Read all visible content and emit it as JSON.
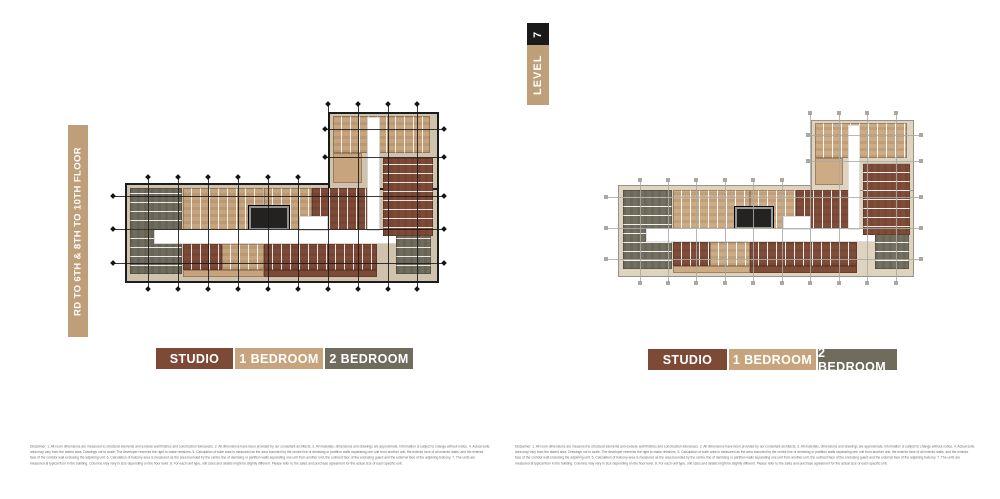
{
  "palette": {
    "studio": "#7d4a37",
    "one_bedroom": "#c7a47d",
    "two_bedroom": "#6f6b5d",
    "core": "#232220",
    "label_tan": "#bf9f7a",
    "label_black": "#1a1a1a"
  },
  "left_page": {
    "floor_label": "RD TO 6TH & 8TH TO 10TH FLOOR"
  },
  "right_page": {
    "level_badge": {
      "number": "7",
      "word": "LEVEL"
    }
  },
  "legend": {
    "items": [
      {
        "label": "STUDIO",
        "key": "studio"
      },
      {
        "label": "1 BEDROOM",
        "key": "one_bedroom"
      },
      {
        "label": "2 BEDROOM",
        "key": "two_bedroom"
      }
    ]
  },
  "disclaimer": "Disclaimer: 1. All room dimensions are measured to structural elements and exclude wall finishes and construction tolerances. 2. All dimensions have been provided by our consultant architects. 3. All materials, dimensions and drawings are approximate. Information is subject to change without notice. 4. Actual suite area may vary from the stated area. Drawings not to scale. The developer reserves the right to make revisions. 5. Calculation of suite area is measured as the area bounded by the centre line of demising or partition walls separating one unit from another unit, the exterior face of all exterior walls, and the exterior face of the corridor wall enclosing the adjoining unit. 6. Calculation of balcony area is measured as the area bounded by the centre line of demising or partition walls separating one unit from another unit, the outmost face of the enclosing guard and the external face of the adjoining balcony. 7. The units are measured at typical floor in the building. Columns may vary in size depending on the floor level. 8. For each unit type, unit sizes and details might be slightly different. Please refer to the sales and purchase agreement for the actual size of each specific unit.",
  "floor_plans": {
    "shared_geometry": {
      "blocks": [
        {
          "x": 2,
          "y": 39,
          "w": 96,
          "h": 52,
          "c": "m",
          "part": true
        },
        {
          "x": 65,
          "y": 1,
          "w": 33,
          "h": 40,
          "c": "m",
          "part": true
        },
        {
          "x": 3.5,
          "y": 42,
          "w": 16,
          "h": 46,
          "c": "t",
          "lines": "h"
        },
        {
          "x": 20,
          "y": 42,
          "w": 25,
          "h": 23,
          "c": "o",
          "lines": "v"
        },
        {
          "x": 45,
          "y": 42,
          "w": 15,
          "h": 23,
          "c": "o",
          "lines": "v"
        },
        {
          "x": 60,
          "y": 42,
          "w": 20,
          "h": 23,
          "c": "s",
          "lines": "v"
        },
        {
          "x": 40,
          "y": 51,
          "w": 13,
          "h": 14,
          "c": "k"
        },
        {
          "x": 11,
          "y": 64,
          "w": 79,
          "h": 8,
          "c": "w"
        },
        {
          "x": 56,
          "y": 57,
          "w": 9,
          "h": 8,
          "c": "w"
        },
        {
          "x": 20,
          "y": 72,
          "w": 12,
          "h": 14,
          "c": "s",
          "lines": "v"
        },
        {
          "x": 32,
          "y": 72,
          "w": 13,
          "h": 14,
          "c": "o",
          "lines": "v"
        },
        {
          "x": 45,
          "y": 72,
          "w": 35,
          "h": 14,
          "c": "s",
          "lines": "v"
        },
        {
          "x": 20,
          "y": 86,
          "w": 25,
          "h": 4,
          "c": "o"
        },
        {
          "x": 45,
          "y": 86,
          "w": 35,
          "h": 4,
          "c": "s"
        },
        {
          "x": 86,
          "y": 66,
          "w": 11,
          "h": 22,
          "c": "t",
          "lines": "h"
        },
        {
          "x": 66.5,
          "y": 3,
          "w": 30,
          "h": 20,
          "c": "o",
          "lines": "v"
        },
        {
          "x": 66.5,
          "y": 23,
          "w": 9,
          "h": 16,
          "c": "o"
        },
        {
          "x": 82,
          "y": 26,
          "w": 15.5,
          "h": 42,
          "c": "s",
          "lines": "h"
        },
        {
          "x": 77,
          "y": 4,
          "w": 4,
          "h": 61,
          "c": "w"
        }
      ],
      "grid": {
        "verticals": [
          {
            "x": 9,
            "y1": 36,
            "y2": 96
          },
          {
            "x": 18.3,
            "y1": 36,
            "y2": 96
          },
          {
            "x": 27.6,
            "y1": 36,
            "y2": 96
          },
          {
            "x": 36.9,
            "y1": 36,
            "y2": 96
          },
          {
            "x": 46.2,
            "y1": 36,
            "y2": 96
          },
          {
            "x": 55.5,
            "y1": 36,
            "y2": 96
          },
          {
            "x": 64.8,
            "y1": -3,
            "y2": 96
          },
          {
            "x": 74.1,
            "y1": -3,
            "y2": 96
          },
          {
            "x": 83.4,
            "y1": -3,
            "y2": 96
          },
          {
            "x": 92.7,
            "y1": -3,
            "y2": 96
          }
        ],
        "horizontals": [
          {
            "y": 46,
            "x1": -2,
            "x2": 101
          },
          {
            "y": 64,
            "x1": -2,
            "x2": 101
          },
          {
            "y": 82,
            "x1": -2,
            "x2": 101
          },
          {
            "y": 10,
            "x1": 64,
            "x2": 101
          },
          {
            "y": 25,
            "x1": 64,
            "x2": 101
          }
        ]
      }
    },
    "instances": [
      {
        "id": "left",
        "wall_color": "#1c1c1c",
        "wall_width": 2,
        "line_color": "#161616",
        "marker": "square-dark",
        "margin_color": "#cfc3ad"
      },
      {
        "id": "right",
        "wall_color": "#8f8d85",
        "wall_width": 1,
        "line_color": "#a6a29a",
        "marker": "square-light",
        "margin_color": "#d6cbb7"
      }
    ]
  }
}
